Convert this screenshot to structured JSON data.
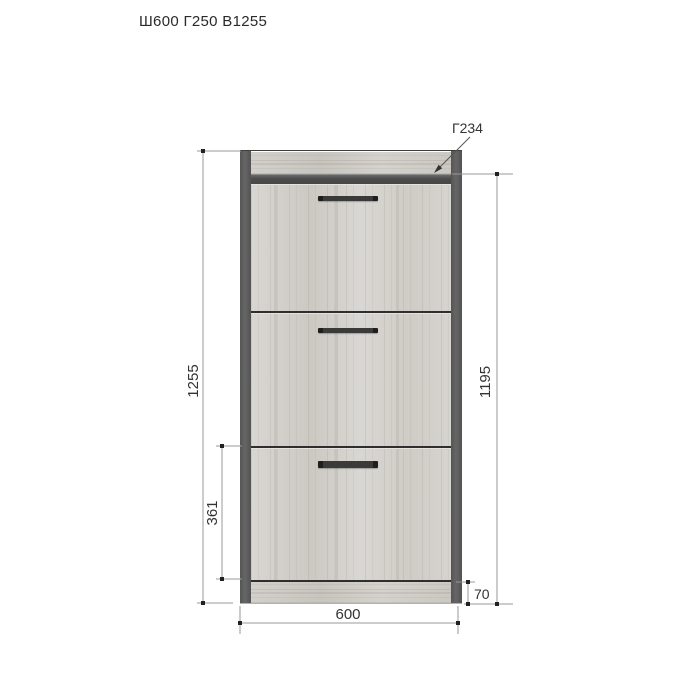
{
  "title": "Ш600 Г250 В1255",
  "callout": {
    "top_depth": "Г234"
  },
  "dimensions": {
    "total_height": "1255",
    "front_height": "1195",
    "lower_section_height": "361",
    "plinth_height": "70",
    "width": "600"
  },
  "cabinet": {
    "door_count": 3
  },
  "colors": {
    "background": "#ffffff",
    "wood": "#d5d3cf",
    "frame": "#5b5b5b",
    "handle": "#2e2e2e",
    "dimension_line": "#9a9a9a",
    "label_text": "#333333"
  }
}
